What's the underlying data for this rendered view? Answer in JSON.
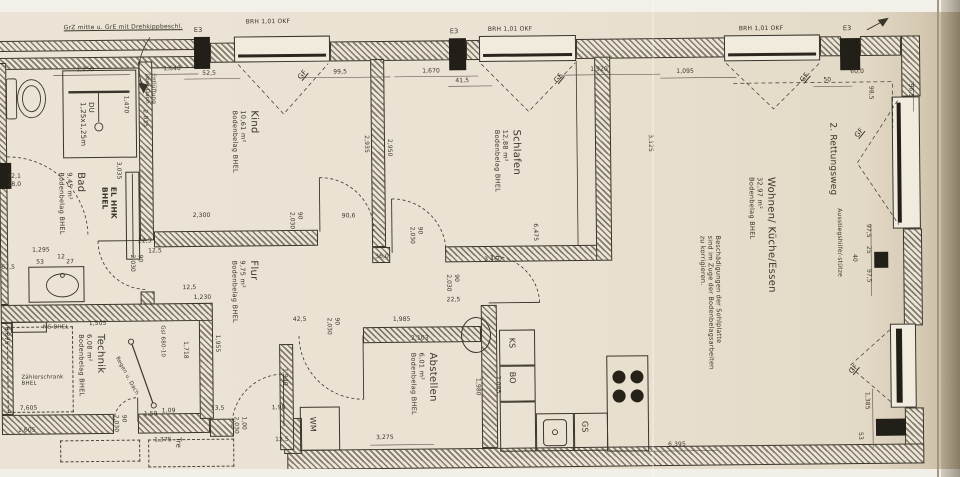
{
  "colors": {
    "paper": "#e9e1d2",
    "ink": "#3a352b"
  },
  "rooms": [
    {
      "name": "Kind",
      "area": "10,61 m²",
      "flooring": "Bodenbelag BHEL",
      "x": 232,
      "y": 108
    },
    {
      "name": "Schlafen",
      "area": "12,88 m²",
      "flooring": "Bodenbelag BHEL",
      "x": 494,
      "y": 130
    },
    {
      "name": "Wohnen/ Küche/Essen",
      "area": "32,97 m²",
      "flooring": "Bodenbelag BHEL",
      "x": 748,
      "y": 180
    },
    {
      "name": "Flur",
      "area": "9,75 m²",
      "flooring": "Bodenbelag BHEL",
      "x": 230,
      "y": 258
    },
    {
      "name": "Abstellen",
      "area": "6,01 m²",
      "flooring": "Bodenbelag BHEL",
      "x": 408,
      "y": 352
    },
    {
      "name": "Technik",
      "area": "6,08 m²",
      "flooring": "Bodenbelag BHEL",
      "x": 76,
      "y": 330
    },
    {
      "name": "Bad",
      "area": "9,45 m²",
      "flooring": "Bodenbelag BHEL",
      "x": 58,
      "y": 168
    }
  ],
  "doors": [
    {
      "size": [
        "90",
        "2,030"
      ],
      "x": 288,
      "y": 210
    },
    {
      "size": [
        "90",
        "2,030"
      ],
      "x": 408,
      "y": 226
    },
    {
      "size": [
        "90",
        "2,030"
      ],
      "x": 128,
      "y": 251
    },
    {
      "size": [
        "90",
        "2,030"
      ],
      "x": 444,
      "y": 274
    },
    {
      "size": [
        "90",
        "2,030"
      ],
      "x": 324,
      "y": 316
    },
    {
      "size": [
        "90",
        "2,030"
      ],
      "x": 110,
      "y": 411
    },
    {
      "size": [
        "1,00",
        "2,030"
      ],
      "x": 230,
      "y": 414
    }
  ],
  "texts": [
    {
      "n": "plan-note",
      "t": "GrZ mitte u. GrE mit Drehkippbeschl.",
      "x": 66,
      "y": 20,
      "fs": 6,
      "u": 1
    },
    {
      "n": "e3-marker",
      "t": "E3",
      "x": 196,
      "y": 24,
      "fs": 6.5
    },
    {
      "n": "e3-marker",
      "t": "E3",
      "x": 452,
      "y": 28,
      "fs": 6.5
    },
    {
      "n": "e3-marker",
      "t": "E3",
      "x": 845,
      "y": 29,
      "fs": 6.5
    },
    {
      "n": "window-sill-label",
      "t": "BRH 1,01 OKF",
      "x": 248,
      "y": 16,
      "fs": 6
    },
    {
      "n": "window-sill-label",
      "t": "BRH 1,01 OKF",
      "x": 490,
      "y": 26,
      "fs": 6
    },
    {
      "n": "window-sill-label",
      "t": "BRH 1,01 OKF",
      "x": 741,
      "y": 28,
      "fs": 6
    },
    {
      "n": "gf-label",
      "t": "GF",
      "x": 298,
      "y": 74,
      "fs": 7,
      "r": -50,
      "u": 1
    },
    {
      "n": "gf-label",
      "t": "GF",
      "x": 554,
      "y": 80,
      "fs": 7,
      "r": -50,
      "u": 1
    },
    {
      "n": "gf-label",
      "t": "GF",
      "x": 800,
      "y": 82,
      "fs": 7,
      "r": -50,
      "u": 1
    },
    {
      "n": "gf-label",
      "t": "GF",
      "x": 854,
      "y": 138,
      "fs": 7,
      "r": -50,
      "u": 1
    },
    {
      "n": "gf-label",
      "t": "GF",
      "x": 846,
      "y": 374,
      "fs": 7,
      "r": -50,
      "u": 1
    },
    {
      "n": "rescue-route-label",
      "t": "2. Rettungsweg",
      "x": 828,
      "y": 126,
      "v": 1,
      "fs": 9
    },
    {
      "n": "exit-aid-label",
      "t": "Ausstiegshilfe/-stütze",
      "x": 836,
      "y": 212,
      "v": 1,
      "fs": 6
    },
    {
      "n": "shower-label",
      "lines": [
        "DU",
        "1,25x1,25m"
      ],
      "x": 80,
      "y": 98,
      "v": 1,
      "fs": 7
    },
    {
      "n": "vent-label",
      "lines": [
        "Entlüftung",
        "über Dach"
      ],
      "x": 145,
      "y": 70,
      "v": 1,
      "fs": 5.5
    },
    {
      "n": "radiator-label",
      "lines": [
        "EL HHK",
        "BHEL"
      ],
      "x": 100,
      "y": 183,
      "v": 1,
      "fs": 7.5,
      "b": 1
    },
    {
      "n": "wohnen-note",
      "lines": [
        "Beschädigungen der Sohlplatte",
        "sind im Zuge der Bodenbelagsarbeiten",
        "zu korrigieren."
      ],
      "x": 698,
      "y": 238,
      "v": 1,
      "fs": 6.5
    },
    {
      "n": "ms-label",
      "t": "MS  BHEL",
      "x": 42,
      "y": 320,
      "fs": 5.5
    },
    {
      "n": "meter-cabinet-label",
      "lines": [
        "Zählerschrank",
        "BHEL"
      ],
      "x": 20,
      "y": 370,
      "fs": 5.5
    },
    {
      "n": "gsl-label",
      "t": "Gsl 680-10",
      "x": 158,
      "y": 322,
      "v": 1,
      "fs": 5.5
    },
    {
      "n": "roof-drain-label",
      "t": "Regen u. Dach",
      "x": 118,
      "y": 352,
      "r": 62,
      "fs": 5.5
    },
    {
      "n": "stairs-label",
      "t": "Tre",
      "x": 172,
      "y": 434,
      "v": 1,
      "fs": 7
    },
    {
      "n": "wm-label",
      "t": "WM",
      "x": 306,
      "y": 415,
      "v": 1,
      "fs": 8
    },
    {
      "n": "ks-label",
      "t": "KS",
      "x": 506,
      "y": 338,
      "v": 1,
      "fs": 8
    },
    {
      "n": "bo-label",
      "t": "BO",
      "x": 506,
      "y": 372,
      "v": 1,
      "fs": 8
    },
    {
      "n": "gs-label",
      "t": "GS",
      "x": 578,
      "y": 422,
      "v": 1,
      "fs": 8
    }
  ],
  "dims": [
    {
      "t": "1,250",
      "x": 78,
      "y": 62
    },
    {
      "t": "1,640",
      "x": 165,
      "y": 62
    },
    {
      "t": "52,5",
      "x": 204,
      "y": 67
    },
    {
      "t": "99,5",
      "x": 335,
      "y": 67
    },
    {
      "t": "1,670",
      "x": 424,
      "y": 67
    },
    {
      "t": "41,5",
      "x": 457,
      "y": 77
    },
    {
      "t": "1,920",
      "x": 592,
      "y": 67
    },
    {
      "t": "1,095",
      "x": 678,
      "y": 70
    },
    {
      "t": "50",
      "x": 825,
      "y": 80
    },
    {
      "t": "60,0",
      "x": 852,
      "y": 72
    },
    {
      "t": "96,5",
      "x": 909,
      "y": 88,
      "v": 1
    },
    {
      "t": "98,5",
      "x": 869,
      "y": 90,
      "v": 1
    },
    {
      "t": "1,470",
      "x": 124,
      "y": 92,
      "v": 1
    },
    {
      "t": "2,835",
      "x": 143,
      "y": 106,
      "v": 1
    },
    {
      "t": "3,035",
      "x": 116,
      "y": 158,
      "v": 1
    },
    {
      "t": "32,1",
      "x": 8,
      "y": 168
    },
    {
      "t": "28,0",
      "x": 8,
      "y": 176
    },
    {
      "t": "1,295",
      "x": 32,
      "y": 242
    },
    {
      "t": "12",
      "x": 57,
      "y": 249
    },
    {
      "t": "53",
      "x": 36,
      "y": 254
    },
    {
      "t": "27",
      "x": 66,
      "y": 254
    },
    {
      "t": "67,5",
      "x": 1,
      "y": 259
    },
    {
      "t": "2,935",
      "x": 364,
      "y": 134,
      "v": 1
    },
    {
      "t": "2,950",
      "x": 387,
      "y": 138,
      "v": 1
    },
    {
      "t": "2,300",
      "x": 193,
      "y": 209
    },
    {
      "t": "90,6",
      "x": 342,
      "y": 211
    },
    {
      "t": "22,5",
      "x": 138,
      "y": 234
    },
    {
      "t": "12,5",
      "x": 148,
      "y": 244
    },
    {
      "t": "36,0",
      "x": 375,
      "y": 252
    },
    {
      "t": "3,460",
      "x": 484,
      "y": 256
    },
    {
      "t": "6,475",
      "x": 532,
      "y": 224,
      "v": 1
    },
    {
      "t": "3,125",
      "x": 648,
      "y": 136,
      "v": 1
    },
    {
      "t": "97,5",
      "x": 865,
      "y": 228,
      "v": 1
    },
    {
      "t": "25",
      "x": 865,
      "y": 250,
      "v": 1
    },
    {
      "t": "40",
      "x": 851,
      "y": 258,
      "v": 1
    },
    {
      "t": "97,5",
      "x": 865,
      "y": 273,
      "v": 1
    },
    {
      "t": "1,385",
      "x": 862,
      "y": 396,
      "v": 1
    },
    {
      "t": "53",
      "x": 855,
      "y": 436,
      "v": 1
    },
    {
      "t": "1,230",
      "x": 193,
      "y": 291
    },
    {
      "t": "12,5",
      "x": 182,
      "y": 281
    },
    {
      "t": "22,5",
      "x": 446,
      "y": 296
    },
    {
      "t": "42,5",
      "x": 292,
      "y": 314
    },
    {
      "t": "1,985",
      "x": 392,
      "y": 315
    },
    {
      "t": "2,103",
      "x": 410,
      "y": 334
    },
    {
      "t": "1,955",
      "x": 213,
      "y": 332,
      "v": 1
    },
    {
      "t": "1,718",
      "x": 181,
      "y": 338,
      "v": 1
    },
    {
      "t": "1,940",
      "x": 280,
      "y": 366,
      "v": 1
    },
    {
      "t": "1,980",
      "x": 473,
      "y": 378,
      "v": 1
    },
    {
      "t": "2,085",
      "x": 493,
      "y": 376,
      "v": 1
    },
    {
      "t": "1,09",
      "x": 160,
      "y": 404
    },
    {
      "t": "13,5",
      "x": 209,
      "y": 402
    },
    {
      "t": "1,90",
      "x": 270,
      "y": 402
    },
    {
      "t": "12,5",
      "x": 273,
      "y": 434
    },
    {
      "t": "1,375",
      "x": 152,
      "y": 433
    },
    {
      "t": "3,275",
      "x": 374,
      "y": 433
    },
    {
      "t": "6,395",
      "x": 666,
      "y": 443
    },
    {
      "t": "1,505",
      "x": 88,
      "y": 316
    },
    {
      "t": "8,075",
      "x": 2,
      "y": 322,
      "v": 1
    },
    {
      "t": "7,605",
      "x": 18,
      "y": 400
    },
    {
      "t": "1,605",
      "x": 16,
      "y": 422
    },
    {
      "t": "1,59",
      "x": 142,
      "y": 407
    }
  ]
}
